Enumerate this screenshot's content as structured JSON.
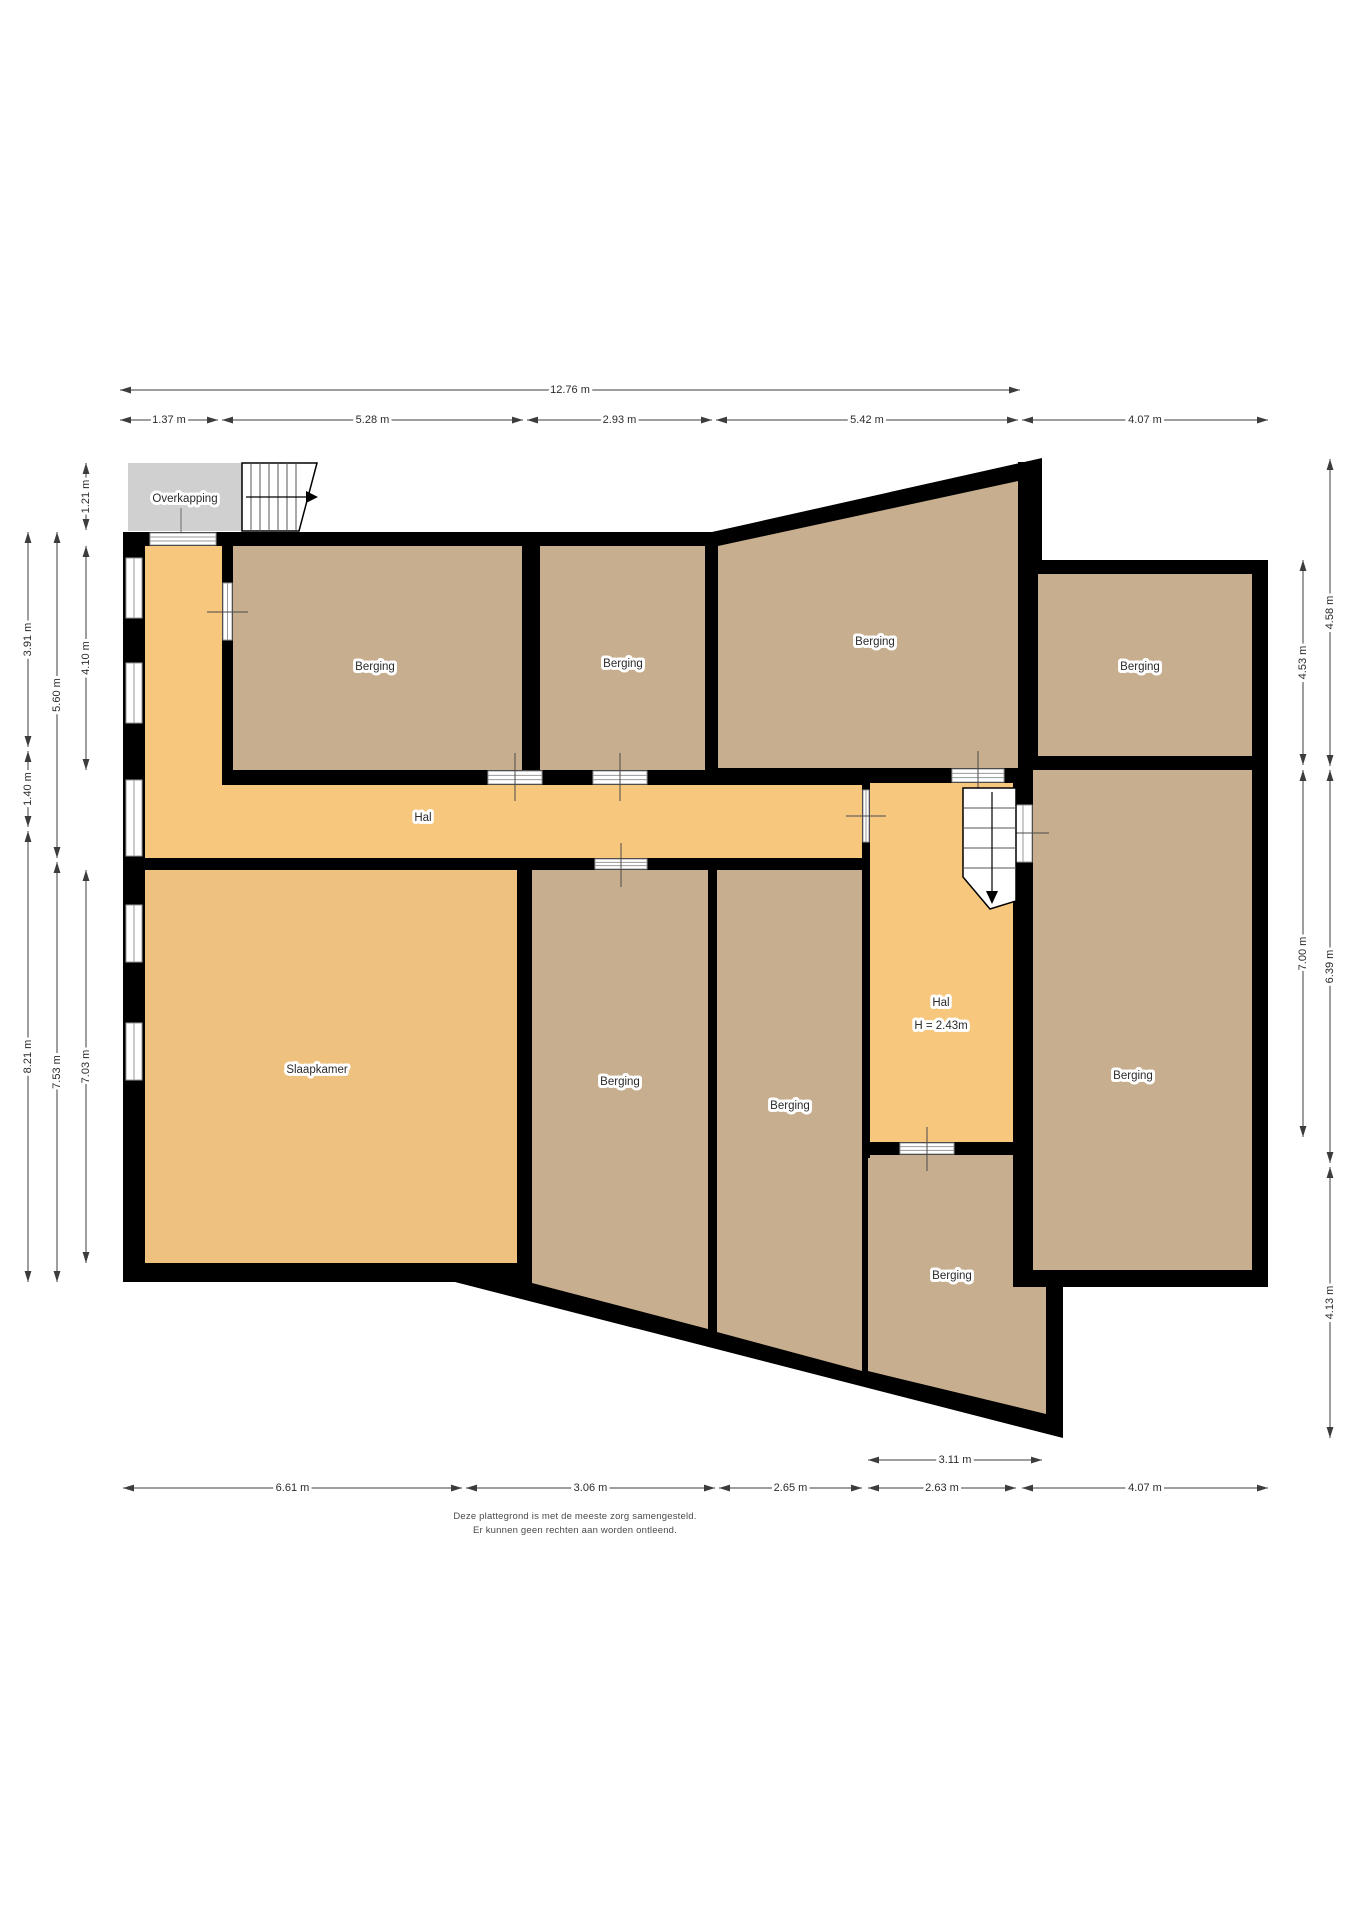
{
  "title": "Plattegrond begane grond",
  "canvas": {
    "width": 1358,
    "height": 1920
  },
  "palette": {
    "wall": "#000000",
    "floor_storage": "#c7ae8e",
    "floor_hall": "#f7c77d",
    "floor_bedroom": "#efc17e",
    "overkapping_fill": "#d0d0d0",
    "window_line": "#9a9a9a",
    "dim_line": "#3c3c3c",
    "label_text": "#2b2b2b"
  },
  "silhouette": [
    [
      123,
      532
    ],
    [
      712,
      532
    ],
    [
      1042,
      458
    ],
    [
      1042,
      560
    ],
    [
      1268,
      560
    ],
    [
      1268,
      1287
    ],
    [
      1063,
      1287
    ],
    [
      1063,
      1438
    ],
    [
      455,
      1282
    ],
    [
      123,
      1282
    ]
  ],
  "rooms": [
    {
      "name": "room-berging-top-left",
      "fill": "floor_storage",
      "points": [
        [
          233,
          546
        ],
        [
          522,
          546
        ],
        [
          522,
          770
        ],
        [
          233,
          770
        ]
      ],
      "label": "Berging",
      "lx": 375,
      "ly": 667
    },
    {
      "name": "room-berging-top-middle",
      "fill": "floor_storage",
      "points": [
        [
          540,
          546
        ],
        [
          705,
          546
        ],
        [
          705,
          770
        ],
        [
          540,
          770
        ]
      ],
      "label": "Berging",
      "lx": 623,
      "ly": 664
    },
    {
      "name": "room-berging-sloped",
      "fill": "floor_storage",
      "points": [
        [
          718,
          546
        ],
        [
          1018,
          481
        ],
        [
          1018,
          768
        ],
        [
          718,
          768
        ]
      ],
      "label": "Berging",
      "lx": 875,
      "ly": 642
    },
    {
      "name": "room-berging-right-top",
      "fill": "floor_storage",
      "points": [
        [
          1038,
          574
        ],
        [
          1252,
          574
        ],
        [
          1252,
          756
        ],
        [
          1038,
          756
        ]
      ],
      "label": "Berging",
      "lx": 1140,
      "ly": 667
    },
    {
      "name": "room-berging-right-middle",
      "fill": "floor_storage",
      "points": [
        [
          1033,
          770
        ],
        [
          1252,
          770
        ],
        [
          1252,
          1270
        ],
        [
          1033,
          1270
        ]
      ],
      "label": "Berging",
      "lx": 1133,
      "ly": 1076
    },
    {
      "name": "room-hal-corridor",
      "fill": "floor_hall",
      "points": [
        [
          145,
          546
        ],
        [
          222,
          546
        ],
        [
          222,
          785
        ],
        [
          862,
          785
        ],
        [
          862,
          858
        ],
        [
          145,
          858
        ]
      ],
      "label": "Hal",
      "lx": 423,
      "ly": 818
    },
    {
      "name": "room-hal-stairwell",
      "fill": "floor_hall",
      "points": [
        [
          870,
          783
        ],
        [
          1013,
          783
        ],
        [
          1013,
          1142
        ],
        [
          870,
          1142
        ]
      ],
      "label": "Hal",
      "lx": 941,
      "ly": 1003,
      "label2": "H = 2.43m",
      "l2x": 941,
      "l2y": 1026
    },
    {
      "name": "room-slaapkamer",
      "fill": "floor_bedroom",
      "points": [
        [
          145,
          870
        ],
        [
          517,
          870
        ],
        [
          517,
          1263
        ],
        [
          145,
          1263
        ]
      ],
      "label": "Slaapkamer",
      "lx": 317,
      "ly": 1070
    },
    {
      "name": "room-berging-center",
      "fill": "floor_storage",
      "points": [
        [
          532,
          870
        ],
        [
          708,
          870
        ],
        [
          708,
          1329
        ],
        [
          532,
          1283
        ]
      ],
      "label": "Berging",
      "lx": 620,
      "ly": 1082
    },
    {
      "name": "room-berging-center-right",
      "fill": "floor_storage",
      "points": [
        [
          717,
          870
        ],
        [
          862,
          870
        ],
        [
          862,
          1371
        ],
        [
          717,
          1332
        ]
      ],
      "label": "Berging",
      "lx": 790,
      "ly": 1106
    },
    {
      "name": "room-berging-bottom",
      "fill": "floor_storage",
      "points": [
        [
          868,
          1155
        ],
        [
          1013,
          1155
        ],
        [
          1013,
          1287
        ],
        [
          1046,
          1287
        ],
        [
          1046,
          1414
        ],
        [
          868,
          1371
        ]
      ],
      "label": "Berging",
      "lx": 952,
      "ly": 1276
    }
  ],
  "walls": [
    {
      "name": "wall-halstrip-east",
      "x": 222,
      "y": 546,
      "w": 11,
      "h": 239
    },
    {
      "name": "wall-b1-bottom",
      "x": 222,
      "y": 770,
      "w": 308,
      "h": 15
    },
    {
      "name": "wall-b1-b2",
      "x": 522,
      "y": 546,
      "w": 18,
      "h": 239
    },
    {
      "name": "wall-b2-bottom",
      "x": 522,
      "y": 770,
      "w": 196,
      "h": 15
    },
    {
      "name": "wall-b2-sloped",
      "x": 705,
      "y": 546,
      "w": 13,
      "h": 239
    },
    {
      "name": "wall-sloped-bottom",
      "x": 705,
      "y": 768,
      "w": 313,
      "h": 15
    },
    {
      "name": "wall-corridor-bottom",
      "x": 145,
      "y": 858,
      "w": 725,
      "h": 12
    },
    {
      "name": "wall-stairhall-west",
      "x": 862,
      "y": 783,
      "w": 8,
      "h": 375
    },
    {
      "name": "wall-stairhall-east",
      "x": 1013,
      "y": 783,
      "w": 20,
      "h": 504
    },
    {
      "name": "wall-stairhall-bottom",
      "x": 862,
      "y": 1142,
      "w": 171,
      "h": 13
    },
    {
      "name": "wall-right-divider",
      "x": 1018,
      "y": 756,
      "w": 234,
      "h": 14
    },
    {
      "name": "wall-slaap-center",
      "x": 517,
      "y": 870,
      "w": 15,
      "h": 418
    },
    {
      "name": "wall-center-centerright",
      "x": 708,
      "y": 870,
      "w": 9,
      "h": 465
    },
    {
      "name": "wall-sloped-wing",
      "x": 1018,
      "y": 462,
      "w": 24,
      "h": 112
    },
    {
      "name": "wall-rightmiddle-bottom",
      "x": 1013,
      "y": 1270,
      "w": 255,
      "h": 17
    }
  ],
  "doors": [
    {
      "name": "entrance-door",
      "x": 150,
      "y": 533,
      "w": 66,
      "h": 12,
      "lines": "h"
    },
    {
      "name": "door-berging-1",
      "x": 488,
      "y": 771,
      "w": 54,
      "h": 13,
      "lines": "h"
    },
    {
      "name": "door-berging-2",
      "x": 593,
      "y": 771,
      "w": 54,
      "h": 13,
      "lines": "h"
    },
    {
      "name": "door-berging-center",
      "x": 595,
      "y": 859,
      "w": 52,
      "h": 10,
      "lines": "h"
    },
    {
      "name": "door-berging-sloped",
      "x": 952,
      "y": 769,
      "w": 52,
      "h": 13,
      "lines": "h"
    },
    {
      "name": "door-hal-west",
      "x": 863,
      "y": 790,
      "w": 6,
      "h": 52,
      "lines": "v"
    },
    {
      "name": "door-hal-east",
      "x": 1014,
      "y": 805,
      "w": 18,
      "h": 57,
      "lines": "v"
    },
    {
      "name": "door-hal-bottom",
      "x": 900,
      "y": 1143,
      "w": 54,
      "h": 11,
      "lines": "h"
    },
    {
      "name": "window-halstrip",
      "x": 223,
      "y": 583,
      "w": 9,
      "h": 57,
      "lines": "v"
    }
  ],
  "windows_left": [
    {
      "name": "window-left-1",
      "x": 126,
      "y": 558,
      "w": 16,
      "h": 60
    },
    {
      "name": "window-left-2",
      "x": 126,
      "y": 663,
      "w": 16,
      "h": 60
    },
    {
      "name": "window-left-3",
      "x": 126,
      "y": 780,
      "w": 16,
      "h": 76
    },
    {
      "name": "window-left-4",
      "x": 126,
      "y": 905,
      "w": 16,
      "h": 57
    },
    {
      "name": "window-left-5",
      "x": 126,
      "y": 1023,
      "w": 16,
      "h": 57
    }
  ],
  "ticks": [
    {
      "name": "tick-door-b1",
      "x1": 515,
      "y1": 753,
      "x2": 515,
      "y2": 801
    },
    {
      "name": "tick-door-b2",
      "x1": 620,
      "y1": 753,
      "x2": 620,
      "y2": 801
    },
    {
      "name": "tick-door-center",
      "x1": 621,
      "y1": 843,
      "x2": 621,
      "y2": 887
    },
    {
      "name": "tick-door-sloped",
      "x1": 978,
      "y1": 751,
      "x2": 978,
      "y2": 799
    },
    {
      "name": "tick-door-halwest",
      "x1": 846,
      "y1": 816,
      "x2": 886,
      "y2": 816
    },
    {
      "name": "tick-door-haleast",
      "x1": 997,
      "y1": 833,
      "x2": 1049,
      "y2": 833
    },
    {
      "name": "tick-door-halbottom",
      "x1": 927,
      "y1": 1127,
      "x2": 927,
      "y2": 1171
    },
    {
      "name": "tick-window-halstrip",
      "x1": 207,
      "y1": 612,
      "x2": 248,
      "y2": 612
    }
  ],
  "overkapping": {
    "name": "overkapping-canopy",
    "x": 128,
    "y": 463,
    "w": 114,
    "h": 68,
    "label": "Overkapping",
    "lx": 185,
    "ly": 499,
    "leader": {
      "x1": 181,
      "y1": 508,
      "x2": 181,
      "y2": 565
    }
  },
  "stairs_top": {
    "name": "stairs-entrance",
    "outline": [
      [
        242,
        463
      ],
      [
        317,
        463
      ],
      [
        299,
        531
      ],
      [
        242,
        531
      ]
    ],
    "risers": [
      [
        251,
        463,
        251,
        531
      ],
      [
        260,
        463,
        260,
        531
      ],
      [
        269,
        463,
        269,
        531
      ],
      [
        278,
        463,
        278,
        531
      ],
      [
        287,
        463,
        287,
        531
      ],
      [
        296,
        463,
        296,
        530
      ]
    ],
    "arrow": {
      "x1": 246,
      "y1": 497,
      "x2": 306,
      "y2": 497,
      "head": [
        [
          306,
          491
        ],
        [
          318,
          497
        ],
        [
          306,
          503
        ]
      ]
    }
  },
  "stairs_hall": {
    "name": "stairs-hal",
    "outline": [
      [
        963,
        788
      ],
      [
        1016,
        788
      ],
      [
        1016,
        901
      ],
      [
        990,
        909
      ],
      [
        963,
        877
      ]
    ],
    "risers": [
      [
        963,
        808,
        1016,
        808
      ],
      [
        963,
        828,
        1016,
        828
      ],
      [
        963,
        848,
        1016,
        848
      ],
      [
        963,
        868,
        1016,
        868
      ]
    ],
    "arrow": {
      "x1": 992,
      "y1": 792,
      "x2": 992,
      "y2": 891,
      "head": [
        [
          986,
          891
        ],
        [
          998,
          891
        ],
        [
          992,
          904
        ]
      ]
    }
  },
  "dimensions_horizontal": [
    {
      "name": "dim-width-total",
      "label": "12.76 m",
      "y": 390,
      "x1": 120,
      "x2": 1020
    },
    {
      "name": "dim-top-1",
      "label": "1.37 m",
      "y": 420,
      "x1": 120,
      "x2": 218
    },
    {
      "name": "dim-top-2",
      "label": "5.28 m",
      "y": 420,
      "x1": 222,
      "x2": 523
    },
    {
      "name": "dim-top-3",
      "label": "2.93 m",
      "y": 420,
      "x1": 527,
      "x2": 712
    },
    {
      "name": "dim-top-4",
      "label": "5.42 m",
      "y": 420,
      "x1": 716,
      "x2": 1018
    },
    {
      "name": "dim-top-5",
      "label": "4.07 m",
      "y": 420,
      "x1": 1022,
      "x2": 1268
    },
    {
      "name": "dim-bottom-311",
      "label": "3.11 m",
      "y": 1460,
      "x1": 868,
      "x2": 1042
    },
    {
      "name": "dim-bottom-1",
      "label": "6.61 m",
      "y": 1488,
      "x1": 123,
      "x2": 462
    },
    {
      "name": "dim-bottom-2",
      "label": "3.06 m",
      "y": 1488,
      "x1": 466,
      "x2": 715
    },
    {
      "name": "dim-bottom-3",
      "label": "2.65 m",
      "y": 1488,
      "x1": 719,
      "x2": 862
    },
    {
      "name": "dim-bottom-4",
      "label": "2.63 m",
      "y": 1488,
      "x1": 868,
      "x2": 1016
    },
    {
      "name": "dim-bottom-5",
      "label": "4.07 m",
      "y": 1488,
      "x1": 1022,
      "x2": 1268
    }
  ],
  "dimensions_vertical": [
    {
      "name": "dim-left-121",
      "label": "1.21 m",
      "x": 86,
      "y1": 463,
      "y2": 530
    },
    {
      "name": "dim-left-410",
      "label": "4.10 m",
      "x": 86,
      "y1": 546,
      "y2": 770
    },
    {
      "name": "dim-left-703",
      "label": "7.03 m",
      "x": 86,
      "y1": 870,
      "y2": 1263
    },
    {
      "name": "dim-left-560",
      "label": "5.60 m",
      "x": 57,
      "y1": 532,
      "y2": 858
    },
    {
      "name": "dim-left-753",
      "label": "7.53 m",
      "x": 57,
      "y1": 862,
      "y2": 1282
    },
    {
      "name": "dim-left-391",
      "label": "3.91 m",
      "x": 28,
      "y1": 532,
      "y2": 747
    },
    {
      "name": "dim-left-140",
      "label": "1.40 m",
      "x": 28,
      "y1": 751,
      "y2": 827
    },
    {
      "name": "dim-left-821",
      "label": "8.21 m",
      "x": 28,
      "y1": 831,
      "y2": 1282
    },
    {
      "name": "dim-right-453",
      "label": "4.53 m",
      "x": 1303,
      "y1": 560,
      "y2": 765
    },
    {
      "name": "dim-right-700",
      "label": "7.00 m",
      "x": 1303,
      "y1": 770,
      "y2": 1137
    },
    {
      "name": "dim-right-458",
      "label": "4.58 m",
      "x": 1330,
      "y1": 459,
      "y2": 766
    },
    {
      "name": "dim-right-639",
      "label": "6.39 m",
      "x": 1330,
      "y1": 770,
      "y2": 1163
    },
    {
      "name": "dim-right-413",
      "label": "4.13 m",
      "x": 1330,
      "y1": 1167,
      "y2": 1438
    }
  ],
  "footer": {
    "line1": "Deze plattegrond is met de meeste zorg samengesteld.",
    "line2": "Er kunnen geen rechten aan worden ontleend."
  }
}
